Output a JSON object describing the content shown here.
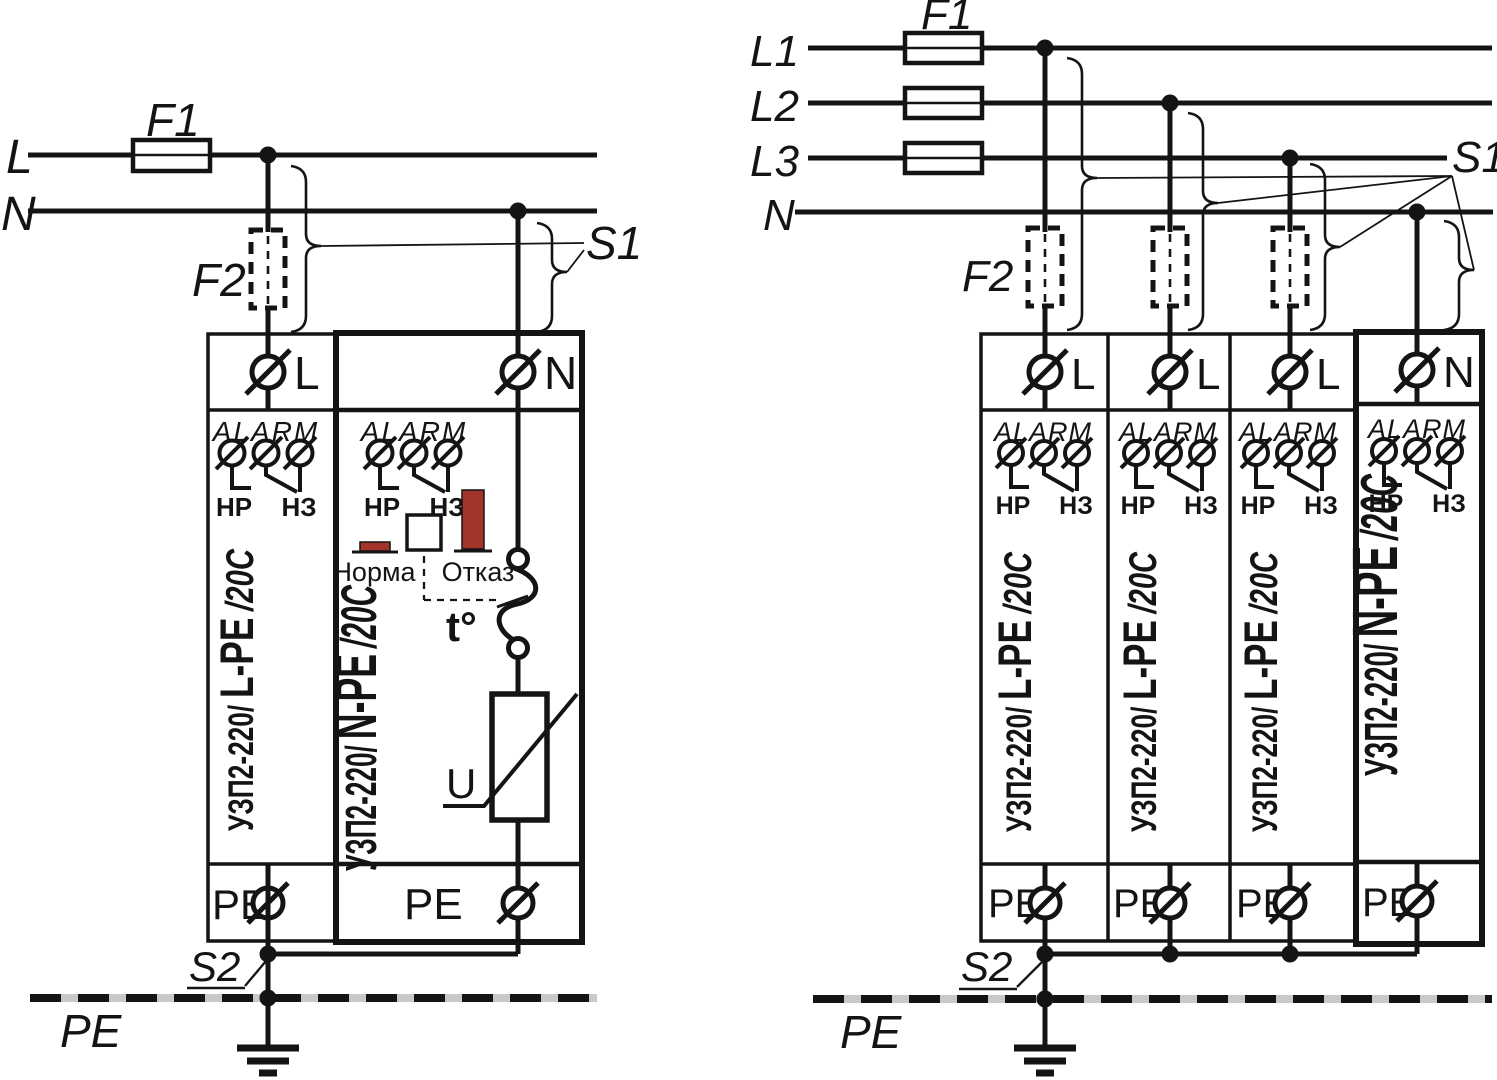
{
  "colors": {
    "ink": "#141414",
    "indicator_red": "#a3342b",
    "pe_gray": "#c9c9c9",
    "background": "#ffffff"
  },
  "left": {
    "line_l": "L",
    "line_n": "N",
    "f1": "F1",
    "f2": "F2",
    "s1": "S1",
    "s2": "S2",
    "pe_label": "PE",
    "module_lpe": {
      "terminal": "L",
      "alarm": "ALARM",
      "no_label": "НР",
      "nc_label": "НЗ",
      "name_prefix": "УЗП2-220/",
      "name_mid": "L-PE",
      "name_suffix": "/20C",
      "pe": "PE"
    },
    "module_npe": {
      "terminal": "N",
      "alarm": "ALARM",
      "no_label": "НР",
      "nc_label": "НЗ",
      "ok_label": "Норма",
      "fail_label": "Отказ",
      "thermal_label": "t°",
      "varistor_label": "U",
      "name_prefix": "УЗП2-220/",
      "name_mid": "N-PE",
      "name_suffix": "/20C",
      "pe": "PE"
    }
  },
  "right": {
    "line_l1": "L1",
    "line_l2": "L2",
    "line_l3": "L3",
    "line_n": "N",
    "f1": "F1",
    "f2": "F2",
    "s1": "S1",
    "s2": "S2",
    "pe_label": "PE",
    "modules": [
      {
        "terminal": "L",
        "alarm": "ALARM",
        "no_label": "НР",
        "nc_label": "НЗ",
        "name_prefix": "УЗП2-220/",
        "name_mid": "L-PE",
        "name_suffix": "/20C",
        "pe": "PE"
      },
      {
        "terminal": "L",
        "alarm": "ALARM",
        "no_label": "НР",
        "nc_label": "НЗ",
        "name_prefix": "УЗП2-220/",
        "name_mid": "L-PE",
        "name_suffix": "/20C",
        "pe": "PE"
      },
      {
        "terminal": "L",
        "alarm": "ALARM",
        "no_label": "НР",
        "nc_label": "НЗ",
        "name_prefix": "УЗП2-220/",
        "name_mid": "L-PE",
        "name_suffix": "/20C",
        "pe": "PE"
      },
      {
        "terminal": "N",
        "alarm": "ALARM",
        "no_label": "НР",
        "nc_label": "НЗ",
        "name_prefix": "УЗП2-220/",
        "name_mid": "N-PE",
        "name_suffix": "/20C",
        "pe": "PE"
      }
    ]
  }
}
